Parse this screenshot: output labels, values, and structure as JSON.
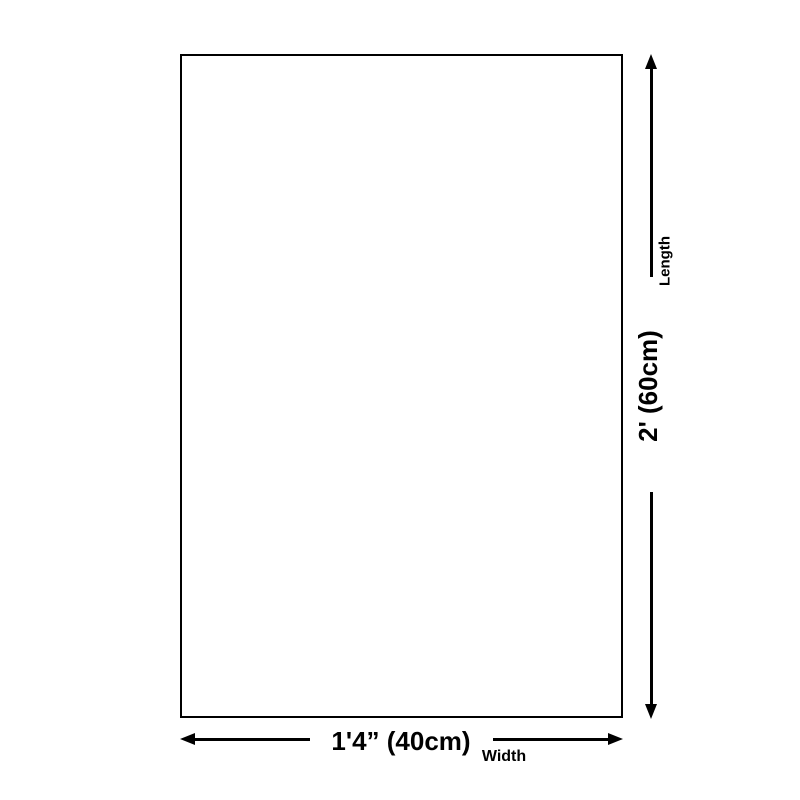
{
  "page": {
    "background_color": "#ffffff",
    "line_color": "#000000"
  },
  "diagram": {
    "shape": "rectangle-outline",
    "dimensions": {
      "length": {
        "axis_label": "Length",
        "measurement": "2' (60cm)"
      },
      "width": {
        "axis_label": "Width",
        "measurement": "1'4” (40cm)"
      }
    }
  },
  "icons": {
    "arrow_up": "arrow-up-icon",
    "arrow_down": "arrow-down-icon",
    "arrow_left": "arrow-left-icon",
    "arrow_right": "arrow-right-icon"
  }
}
